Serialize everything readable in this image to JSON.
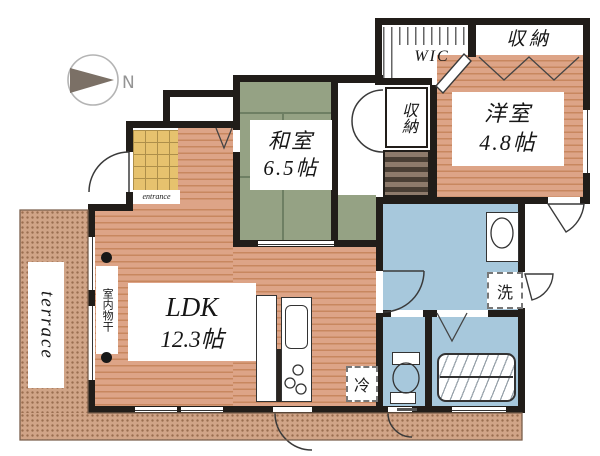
{
  "plan": {
    "compass_label": "N",
    "rooms": {
      "washitsu": {
        "name": "和室",
        "size": "6.5帖"
      },
      "youshitsu": {
        "name": "洋室",
        "size": "4.8帖"
      },
      "ldk": {
        "name": "LDK",
        "size": "12.3帖"
      },
      "wic": {
        "label": "WIC"
      },
      "closet_top": {
        "label": "収納"
      },
      "closet_hall": {
        "label": "収納"
      }
    },
    "fixtures": {
      "washer": {
        "label": "洗"
      },
      "fridge": {
        "label": "冷"
      }
    },
    "outdoor": {
      "terrace_label": "terrace"
    },
    "annotations": {
      "indoor_drying": "室内物干",
      "entrance": "entrance"
    }
  },
  "colors": {
    "wall": "#211d19",
    "wood": "#dda487",
    "woodline": "#c8875f",
    "tatami": "#95a284",
    "tatamiline": "#6e7f63",
    "tile": "#e6c26e",
    "tileline": "#ad8f4a",
    "wet": "#a7c8dc",
    "terrace": "#d0a487",
    "terracedot": "#9a6e50",
    "stripedark": "#493e34",
    "stripelight": "#8d7a6b"
  }
}
